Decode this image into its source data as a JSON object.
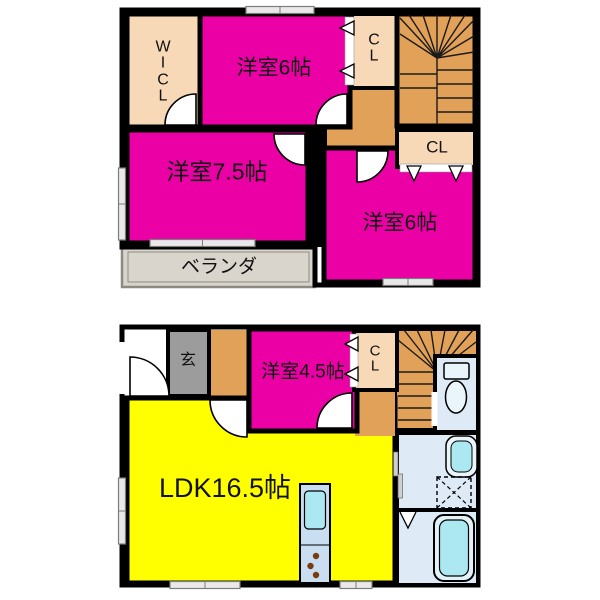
{
  "upper_floor": {
    "wicl_label": "W\nI\nC\nL",
    "bedroom6_top_label": "洋室6帖",
    "closet_top_label": "C\nL",
    "closet_mid_label": "CL",
    "bedroom75_label": "洋室7.5帖",
    "bedroom6_right_label": "洋室6帖",
    "veranda_label": "ベランダ"
  },
  "lower_floor": {
    "entrance_label": "玄",
    "bedroom45_label": "洋室4.5帖",
    "closet_label": "C\nL",
    "ldk_label": "LDK16.5帖"
  },
  "colors": {
    "wall": "#000000",
    "magenta": "#EB00A5",
    "yellow": "#FFFF00",
    "tan": "#E2A159",
    "peach": "#F7D9B8",
    "entry": "#9C9C9C",
    "veranda": "#D9D5CC",
    "room": "#DEEAF6",
    "fixture": "#ACE8F1",
    "kitchen": "#C9DFF1"
  },
  "icons": {
    "toilet": "toilet-icon",
    "bathtub": "bathtub-icon",
    "sink": "sink-icon",
    "washer_pan": "washing-machine-pan-icon",
    "kitchen_sink": "kitchen-sink-icon",
    "stove": "stove-burners-icon",
    "stairs": "stairs-icon",
    "swing_door": "swing-door-icon",
    "folding_door": "folding-door-icon",
    "window": "window-icon"
  }
}
